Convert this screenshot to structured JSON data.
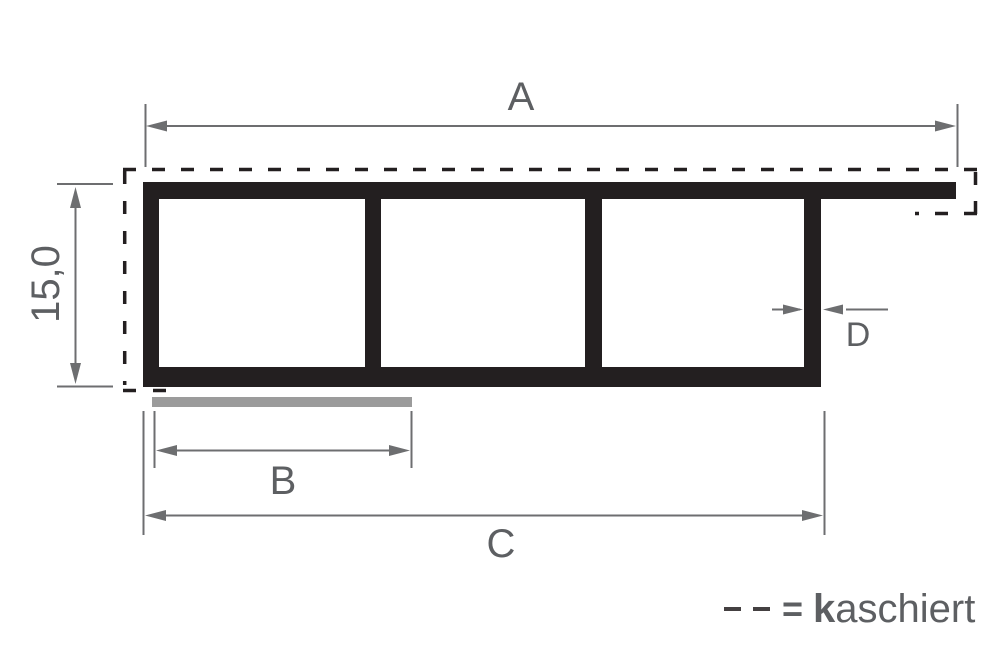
{
  "drawing": {
    "labels": {
      "width_total": "A",
      "height_left": "15,0",
      "width_laminate_strip": "B",
      "width_bottom": "C",
      "wall_thickness": "D"
    },
    "legend": {
      "equals": "=",
      "term_initial": "k",
      "term_rest": "aschiert"
    },
    "colors": {
      "profile": "#231f20",
      "dimension_lines": "#6d6e70",
      "label_text": "#5d5f62",
      "laminate_bar": "#9b9b9b",
      "background": "#ffffff"
    }
  }
}
